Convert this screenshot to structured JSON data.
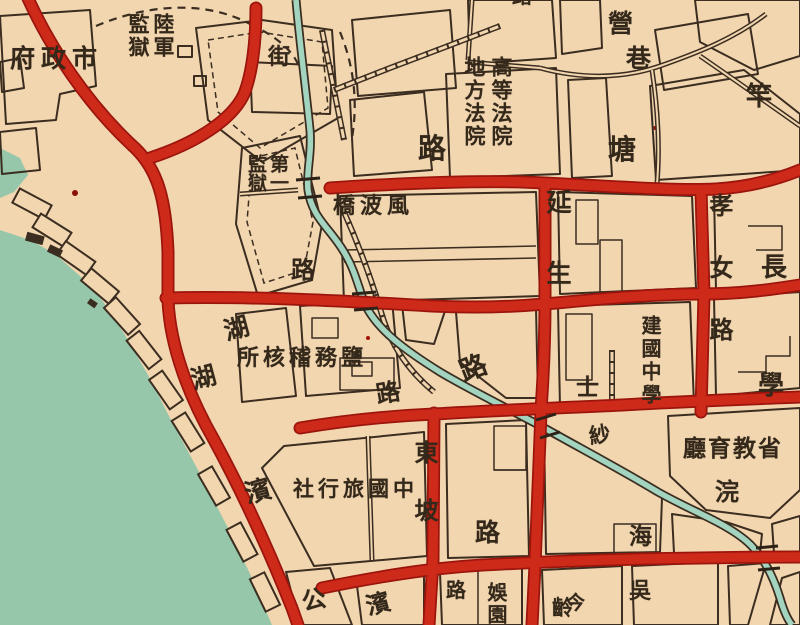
{
  "map": {
    "description": "historical city map section",
    "colors": {
      "land": "#f2d6b0",
      "water": "#96c7ab",
      "road_red": "#ce2a1a",
      "road_red_edge": "#9c150d",
      "canal": "#a3d4c0",
      "line_dark": "#3b2d20",
      "text": "#33281a"
    },
    "labels": [
      {
        "id": "city-government",
        "text": "府政市"
      },
      {
        "id": "army-prison",
        "text": "陸軍\n監獄"
      },
      {
        "id": "jie-street",
        "text": "街"
      },
      {
        "id": "ying",
        "text": "營"
      },
      {
        "id": "xiang",
        "text": "巷"
      },
      {
        "id": "gan",
        "text": "竿"
      },
      {
        "id": "tang",
        "text": "塘"
      },
      {
        "id": "lu-north",
        "text": "路"
      },
      {
        "id": "courts",
        "text": "高等法院\n地方法院"
      },
      {
        "id": "first-prison",
        "text": "第一\n監獄"
      },
      {
        "id": "fengbo-bridge",
        "text": "橋波風"
      },
      {
        "id": "lu-prison",
        "text": "路"
      },
      {
        "id": "yansheng-road",
        "text": "延生"
      },
      {
        "id": "xiaonu-road",
        "text": "孝女路"
      },
      {
        "id": "chang",
        "text": "長"
      },
      {
        "id": "hu-1",
        "text": "湖"
      },
      {
        "id": "hu-2",
        "text": "湖"
      },
      {
        "id": "bin-1",
        "text": "濱"
      },
      {
        "id": "salt-office",
        "text": "所核稽務鹽"
      },
      {
        "id": "lu-canal",
        "text": "路"
      },
      {
        "id": "lu-xueshi",
        "text": "路"
      },
      {
        "id": "shi",
        "text": "士"
      },
      {
        "id": "xue",
        "text": "學"
      },
      {
        "id": "jianguo-school",
        "text": "建國中學"
      },
      {
        "id": "dongpo-road",
        "text": "東坡"
      },
      {
        "id": "lu-dongpo",
        "text": "路"
      },
      {
        "id": "china-travel-service",
        "text": "社行旅國中"
      },
      {
        "id": "lu-south",
        "text": "路"
      },
      {
        "id": "yuyuan",
        "text": "娛園"
      },
      {
        "id": "ling",
        "text": "齡"
      },
      {
        "id": "jin",
        "text": "今"
      },
      {
        "id": "wu",
        "text": "吳"
      },
      {
        "id": "hai",
        "text": "海"
      },
      {
        "id": "education-dept",
        "text": "廳育教省"
      },
      {
        "id": "huan",
        "text": "浣"
      },
      {
        "id": "sha",
        "text": "紗"
      },
      {
        "id": "gong",
        "text": "公"
      },
      {
        "id": "bin-2",
        "text": "濱"
      },
      {
        "id": "top-partial",
        "text": "路"
      }
    ]
  }
}
